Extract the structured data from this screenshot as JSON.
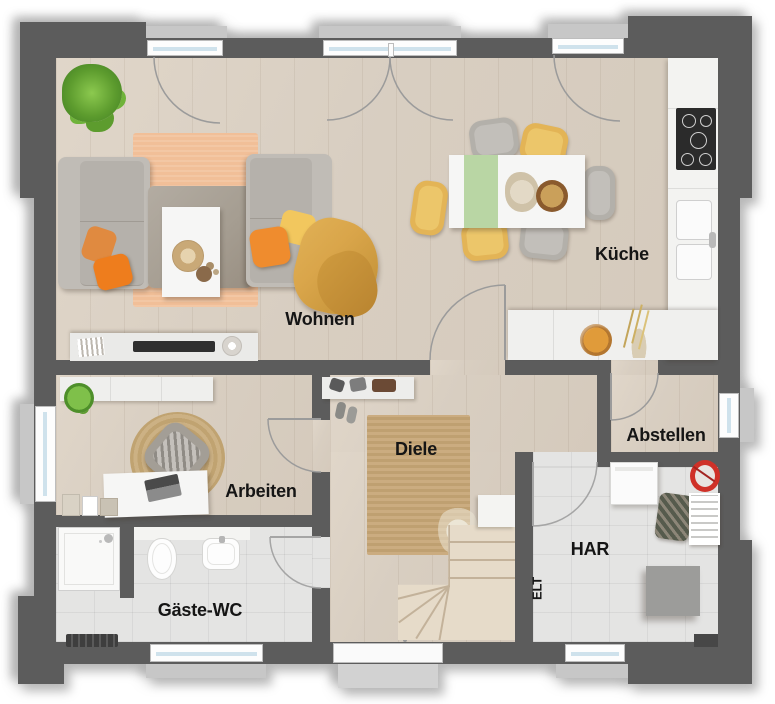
{
  "floorplan": {
    "title": "Erdgeschoss Grundriss",
    "rooms": [
      {
        "id": "wohnen",
        "label": "Wohnen"
      },
      {
        "id": "kueche",
        "label": "Küche"
      },
      {
        "id": "arbeiten",
        "label": "Arbeiten"
      },
      {
        "id": "diele",
        "label": "Diele"
      },
      {
        "id": "gaeste-wc",
        "label": "Gäste-WC"
      },
      {
        "id": "abstellen",
        "label": "Abstellen"
      },
      {
        "id": "har",
        "label": "HAR"
      },
      {
        "id": "elt",
        "label": "ELT"
      }
    ],
    "colors": {
      "wall": "#5c5c5c",
      "wood_floor": "#d8cec1",
      "tile_floor": "#e4e4e3",
      "living_rug": "#f1bf98",
      "jute_rug": "#c8a97e",
      "sofa_gray": "#b7b3ad",
      "accent_orange": "#ed8a2f",
      "accent_yellow": "#eec35f",
      "accent_mustard": "#d9a54a",
      "table_runner_green": "#b9d6a4",
      "plant_green": "#6fae3e",
      "bucket_red": "#cf3128",
      "stairs_wood": "#e6dbc9",
      "window_glass": "#cfe2ec"
    }
  }
}
